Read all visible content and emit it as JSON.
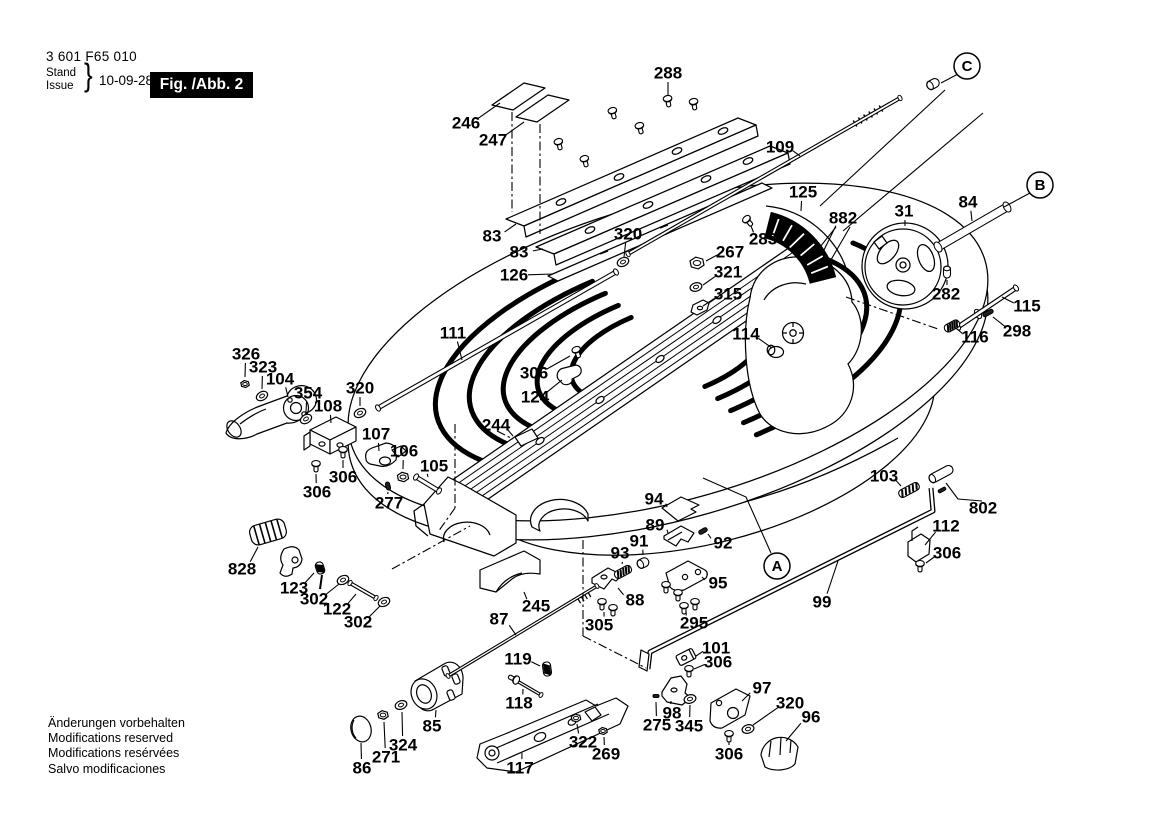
{
  "header": {
    "part_number": "3 601 F65 010",
    "stand": "Stand",
    "issue": "Issue",
    "brace": "}",
    "date": "10-09-28",
    "figure": "Fig. /Abb. 2"
  },
  "footer": {
    "lines": [
      "Änderungen vorbehalten",
      "Modifications reserved",
      "Modifications resérvées",
      "Salvo modificaciones"
    ]
  },
  "colors": {
    "ink": "#000000",
    "paper": "#ffffff",
    "badge_bg": "#000000",
    "badge_fg": "#ffffff"
  },
  "callouts": [
    {
      "label": "A",
      "x": 777,
      "y": 566,
      "leader": [
        [
          703,
          478
        ],
        [
          746,
          497
        ],
        [
          771,
          553
        ]
      ]
    },
    {
      "label": "B",
      "x": 1040,
      "y": 185,
      "leader": [
        [
          1030,
          193
        ],
        [
          1004,
          207
        ]
      ]
    },
    {
      "label": "C",
      "x": 967,
      "y": 66,
      "leader": [
        [
          958,
          74
        ],
        [
          941,
          83
        ]
      ]
    }
  ],
  "part_labels": [
    {
      "t": "288",
      "x": 668,
      "y": 73,
      "lx": 668,
      "ly": 95
    },
    {
      "t": "246",
      "x": 466,
      "y": 123,
      "lx": 500,
      "ly": 103
    },
    {
      "t": "247",
      "x": 493,
      "y": 140,
      "lx": 524,
      "ly": 122
    },
    {
      "t": "83",
      "x": 492,
      "y": 236,
      "lx": 516,
      "ly": 224
    },
    {
      "t": "83",
      "x": 519,
      "y": 252,
      "lx": 543,
      "ly": 249
    },
    {
      "t": "126",
      "x": 514,
      "y": 275,
      "lx": 553,
      "ly": 274
    },
    {
      "t": "320",
      "x": 628,
      "y": 234,
      "lx": 624,
      "ly": 257
    },
    {
      "t": "109",
      "x": 780,
      "y": 147,
      "lx": 800,
      "ly": 156
    },
    {
      "t": "125",
      "x": 803,
      "y": 192,
      "lx": 801,
      "ly": 211
    },
    {
      "t": "882",
      "x": 843,
      "y": 218,
      "lx": 823,
      "ly": 252
    },
    {
      "t": "283",
      "x": 763,
      "y": 239,
      "lx": 751,
      "ly": 226
    },
    {
      "t": "267",
      "x": 730,
      "y": 252,
      "lx": 706,
      "ly": 261
    },
    {
      "t": "321",
      "x": 728,
      "y": 272,
      "lx": 703,
      "ly": 285
    },
    {
      "t": "315",
      "x": 728,
      "y": 294,
      "lx": 703,
      "ly": 306
    },
    {
      "t": "31",
      "x": 904,
      "y": 211,
      "lx": 905,
      "ly": 226
    },
    {
      "t": "84",
      "x": 968,
      "y": 202,
      "lx": 972,
      "ly": 221
    },
    {
      "t": "282",
      "x": 946,
      "y": 294,
      "lx": 947,
      "ly": 280
    },
    {
      "t": "115",
      "x": 1027,
      "y": 306,
      "lx": 1002,
      "ly": 297
    },
    {
      "t": "298",
      "x": 1017,
      "y": 331,
      "lx": 993,
      "ly": 317
    },
    {
      "t": "116",
      "x": 975,
      "y": 337,
      "lx": 957,
      "ly": 329
    },
    {
      "t": "114",
      "x": 746,
      "y": 334,
      "lx": 772,
      "ly": 348
    },
    {
      "t": "111",
      "x": 453,
      "y": 333,
      "lx": 462,
      "ly": 360
    },
    {
      "t": "306",
      "x": 534,
      "y": 373,
      "lx": 570,
      "ly": 356
    },
    {
      "t": "124",
      "x": 535,
      "y": 397,
      "lx": 562,
      "ly": 380
    },
    {
      "t": "326",
      "x": 246,
      "y": 354,
      "lx": 245,
      "ly": 377
    },
    {
      "t": "323",
      "x": 263,
      "y": 367,
      "lx": 262,
      "ly": 389
    },
    {
      "t": "104",
      "x": 280,
      "y": 379,
      "lx": 288,
      "ly": 397
    },
    {
      "t": "354",
      "x": 308,
      "y": 393,
      "lx": 306,
      "ly": 412
    },
    {
      "t": "108",
      "x": 328,
      "y": 406,
      "lx": 331,
      "ly": 423
    },
    {
      "t": "320",
      "x": 360,
      "y": 388,
      "lx": 360,
      "ly": 406
    },
    {
      "t": "107",
      "x": 376,
      "y": 434,
      "lx": 379,
      "ly": 451
    },
    {
      "t": "106",
      "x": 404,
      "y": 451,
      "lx": 403,
      "ly": 469
    },
    {
      "t": "105",
      "x": 434,
      "y": 466,
      "lx": 428,
      "ly": 477
    },
    {
      "t": "306",
      "x": 343,
      "y": 477,
      "lx": 343,
      "ly": 460
    },
    {
      "t": "306",
      "x": 317,
      "y": 492,
      "lx": 316,
      "ly": 474
    },
    {
      "t": "277",
      "x": 389,
      "y": 503,
      "lx": 388,
      "ly": 492
    },
    {
      "t": "244",
      "x": 496,
      "y": 425,
      "lx": 513,
      "ly": 436
    },
    {
      "t": "103",
      "x": 884,
      "y": 476,
      "lx": 901,
      "ly": 486
    },
    {
      "t": "802",
      "x": 983,
      "y": 508
    },
    {
      "t": "112",
      "x": 946,
      "y": 526,
      "lx": 925,
      "ly": 545
    },
    {
      "t": "306",
      "x": 947,
      "y": 553,
      "lx": 926,
      "ly": 563
    },
    {
      "t": "94",
      "x": 654,
      "y": 499,
      "lx": 667,
      "ly": 507
    },
    {
      "t": "89",
      "x": 655,
      "y": 525,
      "lx": 668,
      "ly": 533
    },
    {
      "t": "91",
      "x": 639,
      "y": 541,
      "lx": 643,
      "ly": 555
    },
    {
      "t": "93",
      "x": 620,
      "y": 553,
      "lx": 622,
      "ly": 564
    },
    {
      "t": "92",
      "x": 723,
      "y": 543,
      "lx": 708,
      "ly": 534
    },
    {
      "t": "95",
      "x": 718,
      "y": 583,
      "lx": 702,
      "ly": 577
    },
    {
      "t": "88",
      "x": 635,
      "y": 600,
      "lx": 618,
      "ly": 588
    },
    {
      "t": "305",
      "x": 599,
      "y": 625,
      "lx": 604,
      "ly": 612
    },
    {
      "t": "295",
      "x": 694,
      "y": 623,
      "lx": 686,
      "ly": 611
    },
    {
      "t": "828",
      "x": 242,
      "y": 569,
      "lx": 258,
      "ly": 547
    },
    {
      "t": "123",
      "x": 294,
      "y": 588,
      "lx": 314,
      "ly": 573
    },
    {
      "t": "302",
      "x": 314,
      "y": 599,
      "lx": 339,
      "ly": 584
    },
    {
      "t": "122",
      "x": 337,
      "y": 609,
      "lx": 356,
      "ly": 594
    },
    {
      "t": "302",
      "x": 358,
      "y": 622,
      "lx": 380,
      "ly": 606
    },
    {
      "t": "245",
      "x": 536,
      "y": 606,
      "lx": 524,
      "ly": 592
    },
    {
      "t": "87",
      "x": 499,
      "y": 619,
      "lx": 516,
      "ly": 635
    },
    {
      "t": "99",
      "x": 822,
      "y": 602,
      "lx": 838,
      "ly": 561
    },
    {
      "t": "101",
      "x": 716,
      "y": 648,
      "lx": 696,
      "ly": 656
    },
    {
      "t": "306",
      "x": 718,
      "y": 662,
      "lx": 694,
      "ly": 669
    },
    {
      "t": "119",
      "x": 518,
      "y": 659,
      "lx": 540,
      "ly": 666
    },
    {
      "t": "118",
      "x": 519,
      "y": 703,
      "lx": 523,
      "ly": 689
    },
    {
      "t": "85",
      "x": 432,
      "y": 726,
      "lx": 436,
      "ly": 710
    },
    {
      "t": "324",
      "x": 403,
      "y": 745,
      "lx": 402,
      "ly": 712
    },
    {
      "t": "271",
      "x": 386,
      "y": 757,
      "lx": 384,
      "ly": 722
    },
    {
      "t": "86",
      "x": 362,
      "y": 768,
      "lx": 361,
      "ly": 743
    },
    {
      "t": "117",
      "x": 520,
      "y": 768,
      "lx": 522,
      "ly": 753
    },
    {
      "t": "322",
      "x": 583,
      "y": 742,
      "lx": 577,
      "ly": 724
    },
    {
      "t": "269",
      "x": 606,
      "y": 754,
      "lx": 604,
      "ly": 737
    },
    {
      "t": "97",
      "x": 762,
      "y": 688,
      "lx": 742,
      "ly": 701
    },
    {
      "t": "98",
      "x": 672,
      "y": 713,
      "lx": 671,
      "ly": 701
    },
    {
      "t": "275",
      "x": 657,
      "y": 725,
      "lx": 656,
      "ly": 702
    },
    {
      "t": "345",
      "x": 689,
      "y": 726,
      "lx": 690,
      "ly": 705
    },
    {
      "t": "320",
      "x": 790,
      "y": 703,
      "lx": 753,
      "ly": 725
    },
    {
      "t": "96",
      "x": 811,
      "y": 717,
      "lx": 786,
      "ly": 741
    },
    {
      "t": "306",
      "x": 729,
      "y": 754,
      "lx": 729,
      "ly": 742
    }
  ],
  "hardware": {
    "screws": [
      [
        559,
        144,
        -15
      ],
      [
        585,
        161,
        -15
      ],
      [
        613,
        113,
        -15
      ],
      [
        640,
        128,
        -15
      ],
      [
        668,
        101,
        -10
      ],
      [
        694,
        104,
        -10
      ],
      [
        577,
        352,
        -20
      ],
      [
        748,
        221,
        -40
      ],
      [
        316,
        466,
        0
      ],
      [
        343,
        452,
        0
      ],
      [
        602,
        604,
        0
      ],
      [
        613,
        610,
        0
      ],
      [
        666,
        587,
        0
      ],
      [
        678,
        595,
        0
      ],
      [
        684,
        608,
        0
      ],
      [
        695,
        604,
        0
      ],
      [
        920,
        566,
        0
      ],
      [
        689,
        671,
        0
      ],
      [
        729,
        736,
        0
      ],
      [
        514,
        679,
        115
      ]
    ],
    "washers": [
      [
        623,
        262,
        -25
      ],
      [
        360,
        413,
        -25
      ],
      [
        306,
        419,
        -30
      ],
      [
        262,
        396,
        -30
      ],
      [
        343,
        580,
        -25
      ],
      [
        384,
        602,
        -25
      ],
      [
        696,
        287,
        -15
      ],
      [
        401,
        705,
        -20
      ],
      [
        748,
        729,
        -15
      ],
      [
        690,
        699,
        -15
      ]
    ],
    "nuts": [
      [
        245,
        384,
        4.5
      ],
      [
        697,
        263,
        7.5
      ],
      [
        403,
        477,
        6
      ],
      [
        383,
        715,
        5.5
      ],
      [
        576,
        718,
        5
      ],
      [
        603,
        731,
        4.5
      ]
    ],
    "springs": [
      [
        909,
        490,
        -28,
        22
      ],
      [
        952,
        326,
        -28,
        16
      ],
      [
        623,
        572,
        -28,
        18
      ],
      [
        547,
        669,
        82,
        14
      ],
      [
        320,
        568,
        72,
        12
      ]
    ],
    "pins": [
      [
        988,
        313,
        -28,
        11,
        4
      ],
      [
        703,
        531,
        -30,
        9,
        4
      ],
      [
        656,
        696,
        0,
        6,
        3
      ],
      [
        388,
        486,
        75,
        8,
        4
      ],
      [
        947,
        272,
        90,
        12,
        7
      ],
      [
        933,
        84,
        -28,
        13,
        9
      ],
      [
        643,
        563,
        -25,
        12,
        9
      ],
      [
        941,
        474,
        -28,
        26,
        9
      ],
      [
        942,
        490,
        -28,
        8,
        3
      ]
    ],
    "rods": [
      [
        628,
        254,
        900,
        98,
        4
      ],
      [
        378,
        408,
        616,
        272,
        5
      ],
      [
        938,
        247,
        1007,
        207,
        9
      ],
      [
        958,
        327,
        1016,
        288,
        5
      ],
      [
        350,
        583,
        376,
        598,
        4
      ],
      [
        416,
        477,
        439,
        491,
        5
      ],
      [
        517,
        681,
        541,
        695,
        3.5
      ],
      [
        448,
        676,
        597,
        586,
        3.5
      ]
    ],
    "guides": [
      [
        512,
        112,
        512,
        212
      ],
      [
        540,
        124,
        540,
        234
      ],
      [
        846,
        297,
        938,
        329
      ],
      [
        392,
        569,
        470,
        526
      ],
      [
        583,
        540,
        583,
        636
      ],
      [
        583,
        636,
        646,
        668
      ],
      [
        455,
        424,
        455,
        508
      ],
      [
        455,
        508,
        438,
        532
      ],
      [
        497,
        431,
        513,
        439
      ]
    ],
    "vlines": [
      [
        945,
        90,
        820,
        206
      ],
      [
        983,
        113,
        843,
        231
      ],
      [
        836,
        227,
        812,
        257
      ],
      [
        850,
        227,
        828,
        265
      ]
    ]
  }
}
